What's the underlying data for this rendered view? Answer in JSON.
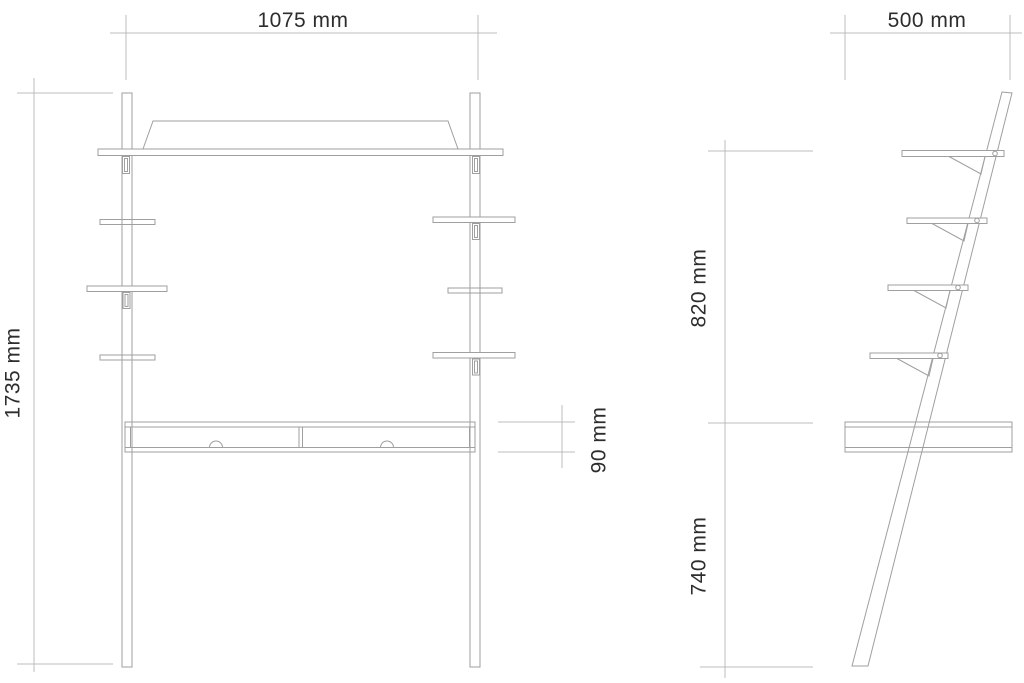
{
  "page": {
    "background": "#ffffff"
  },
  "drawing": {
    "type": "technical-drawing",
    "subject": "leaning ladder desk with shelves - front and side elevations",
    "structure_line_color": "#9f9f9f",
    "dimension_line_color": "#bcbcbc",
    "text_color": "#2d2d2d",
    "views": {
      "front": {
        "name": "front-elevation",
        "dimensions": {
          "overall_width": {
            "label": "1075 mm",
            "orientation": "horizontal",
            "position": "top"
          },
          "overall_height": {
            "label": "1735 mm",
            "orientation": "vertical",
            "position": "left"
          },
          "desk_unit_thickness": {
            "label": "90 mm",
            "orientation": "vertical",
            "position": "right-of-desk"
          }
        },
        "features": [
          "two vertical posts",
          "full-width top shelf with splayed back rail",
          "three side shelf levels per post",
          "desk unit with two drawers and half-round finger pulls"
        ]
      },
      "side": {
        "name": "side-elevation",
        "dimensions": {
          "depth": {
            "label": "500 mm",
            "orientation": "horizontal",
            "position": "top"
          },
          "shelf_zone_height": {
            "label": "820 mm",
            "orientation": "vertical",
            "position": "left-upper"
          },
          "desk_surface_height": {
            "label": "740 mm",
            "orientation": "vertical",
            "position": "left-lower"
          }
        },
        "features": [
          "single leaning slat",
          "four shelf boards with triangular brackets and fixing screws",
          "desk box section"
        ]
      }
    }
  }
}
